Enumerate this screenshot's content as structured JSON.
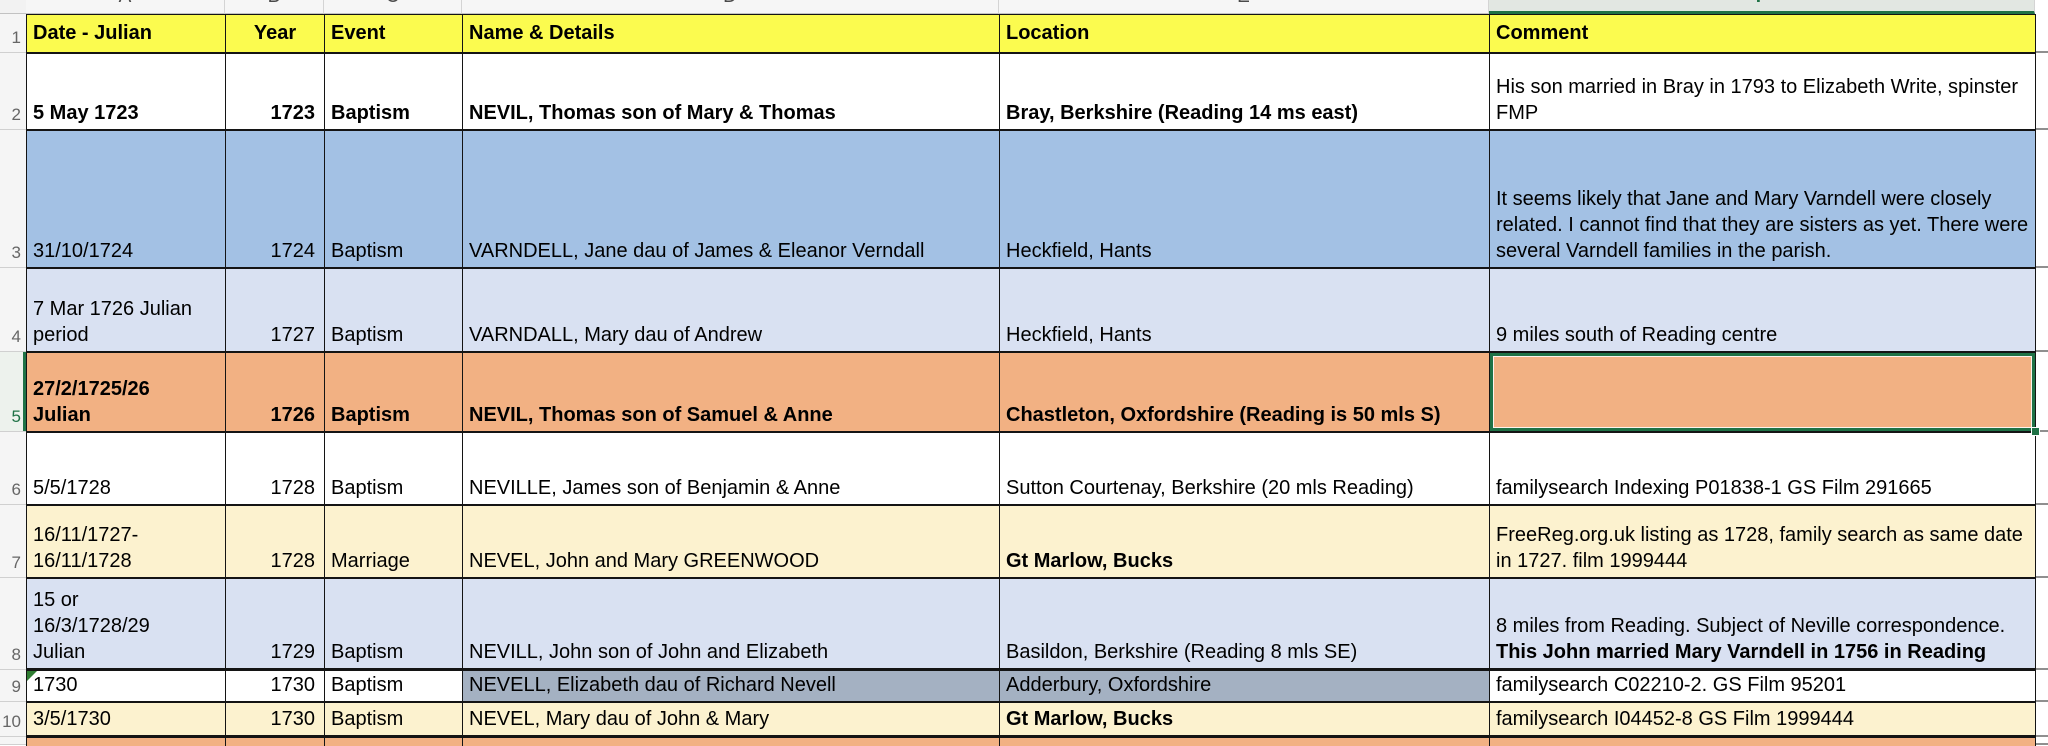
{
  "sheet": {
    "column_letters": [
      "A",
      "B",
      "C",
      "D",
      "E",
      "F"
    ],
    "selected_column_letter": "F",
    "row_numbers": [
      "1",
      "2",
      "3",
      "4",
      "5",
      "6",
      "7",
      "8",
      "9",
      "10"
    ],
    "selected_row_number": "5",
    "table": {
      "headers": [
        "Date - Julian",
        "Year",
        "Event",
        "Name & Details",
        "Location",
        "Comment"
      ],
      "rows": [
        {
          "date": "5 May 1723",
          "year": "1723",
          "event": "Baptism",
          "name": "NEVIL, Thomas son of Mary & Thomas",
          "location": "Bray, Berkshire (Reading 14 ms east)",
          "comment": "His son married in Bray in 1793 to Elizabeth Write, spinster FMP",
          "comment_bold": ""
        },
        {
          "date": "31/10/1724",
          "year": "1724",
          "event": "Baptism",
          "name": "VARNDELL, Jane dau of James & Eleanor Verndall",
          "location": "Heckfield, Hants",
          "comment": "It seems likely that Jane and Mary Varndell were closely related. I cannot find that they are sisters as yet. There were several Varndell families in the parish.",
          "comment_bold": ""
        },
        {
          "date": "7 Mar 1726 Julian\nperiod",
          "year": "1727",
          "event": "Baptism",
          "name": "VARNDALL, Mary dau of Andrew",
          "location": "Heckfield, Hants",
          "comment": "9 miles south of Reading centre",
          "comment_bold": ""
        },
        {
          "date": "27/2/1725/26\nJulian",
          "year": "1726",
          "event": "Baptism",
          "name": "NEVIL, Thomas son of Samuel & Anne",
          "location": "Chastleton, Oxfordshire (Reading is 50 mls S)",
          "comment": "",
          "comment_bold": ""
        },
        {
          "date": "5/5/1728",
          "year": "1728",
          "event": "Baptism",
          "name": "NEVILLE, James son of Benjamin & Anne",
          "location": "Sutton Courtenay, Berkshire (20 mls Reading)",
          "comment": "familysearch Indexing P01838-1 GS Film 291665",
          "comment_bold": ""
        },
        {
          "date": "16/11/1727-\n16/11/1728",
          "year": "1728",
          "event": "Marriage",
          "name": "NEVEL, John and Mary GREENWOOD",
          "location": "Gt Marlow, Bucks",
          "comment": "FreeReg.org.uk listing as 1728, family search as same date in 1727. film 1999444",
          "comment_bold": ""
        },
        {
          "date": "15 or\n16/3/1728/29\nJulian",
          "year": "1729",
          "event": "Baptism",
          "name": "NEVILL, John son of John and Elizabeth",
          "location": "Basildon, Berkshire (Reading 8 mls SE)",
          "comment": "8 miles from Reading. Subject of Neville correspondence. ",
          "comment_bold": "This John married Mary Varndell in 1756 in Reading"
        },
        {
          "date": "1730",
          "year": "1730",
          "event": "Baptism",
          "name": "NEVELL, Elizabeth dau of Richard Nevell",
          "location": "Adderbury, Oxfordshire",
          "comment": "familysearch C02210-2. GS Film 95201",
          "comment_bold": ""
        },
        {
          "date": "3/5/1730",
          "year": "1730",
          "event": "Baptism",
          "name": "NEVEL, Mary dau of John & Mary",
          "location": "Gt Marlow, Bucks",
          "comment": "familysearch  I04452-8 GS Film 1999444",
          "comment_bold": ""
        }
      ]
    },
    "colors": {
      "header_fill": "#FBFB4F",
      "row_blue": "#A3C1E4",
      "row_lavender": "#D9E1F2",
      "row_orange": "#F2B183",
      "row_cream": "#FCF2CF",
      "row_slate": "#A4B1C2",
      "selection_green": "#1F7246"
    }
  }
}
